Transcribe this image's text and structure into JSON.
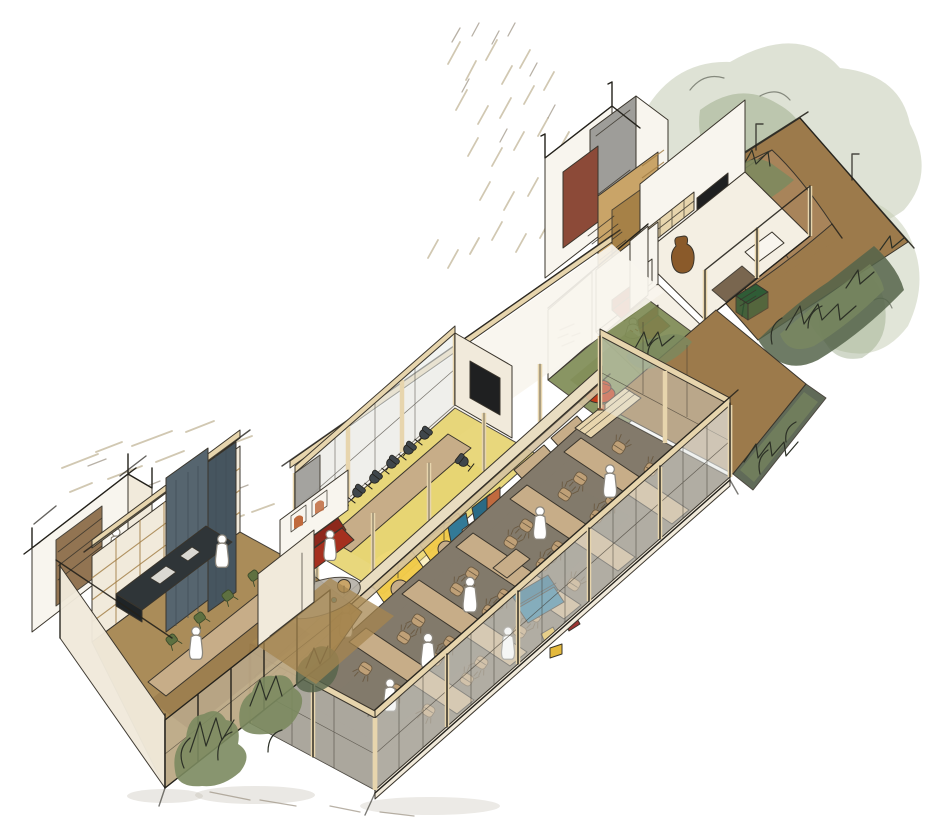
{
  "illustration": {
    "type": "axonometric-cutaway-sketch",
    "subject": "Hand-drawn watercolor axonometric cutaway of an office and hospitality interior with garden terrace",
    "rooms": [
      {
        "id": "garden-terrace",
        "label": "Garden terrace with canvas canopy and dense planting"
      },
      {
        "id": "utility-block",
        "label": "WC and utility block with gray and terracotta walls"
      },
      {
        "id": "media-lounge",
        "label": "Lounge with wall screen, shelving and vase"
      },
      {
        "id": "heart-nook",
        "label": "Seating nook with red armchairs and heart artwork"
      },
      {
        "id": "turf-patio",
        "label": "Indoor green turf patio with red pouf"
      },
      {
        "id": "focus-booths",
        "label": "Focus booths with yellow alcoves and blue bench seating"
      },
      {
        "id": "meeting-room",
        "label": "Glazed meeting room with long table and task chairs"
      },
      {
        "id": "dining-hall",
        "label": "Glazed dining hall with long communal tables"
      },
      {
        "id": "garden-path",
        "label": "Planted garden path along the facade"
      },
      {
        "id": "library-lounge",
        "label": "Lounge with shelf wall, slate curtain, dark stage table and red sofa"
      },
      {
        "id": "planter-facade",
        "label": "Glazed facade with planter boxes"
      }
    ],
    "furniture_counts": {
      "dining_tables": 5,
      "dining_chairs": 26,
      "meeting_chairs": 8,
      "sofas": 3,
      "armchairs": 2,
      "poufs": 1,
      "framed_artworks": 4
    }
  },
  "palette": {
    "paper": "#ffffff",
    "ink": "#3a352c",
    "ink_dark": "#23211b",
    "pencil": "#cfc5ae",
    "pencil_dark": "#9a9080",
    "wall_cream": "#f1eadb",
    "wall_white": "#f8f5ee",
    "wall_shade": "#e3dac6",
    "wall_gray": "#9e9d99",
    "terracotta": "#8c4a38",
    "wood_light": "#e7d5ad",
    "wood_tan": "#c9a468",
    "wood_dark": "#a07c42",
    "floor_ochre": "#a5854f",
    "floor_hall": "#837a6b",
    "floor_cream": "#f4efe3",
    "turf_green": "#7d8a53",
    "floor_yellow": "#e6d36e",
    "alcove_yellow": "#f2cb49",
    "table_beige": "#c7ad88",
    "counter_beige": "#e9ddc1",
    "counter_shade": "#d6c4a2",
    "chair_tan": "#bfa077",
    "chair_dark": "#3f464b",
    "chair_green": "#5e7040",
    "curtain_slate": "#56656f",
    "curtain_dark": "#46555f",
    "sofa_red": "#a5301f",
    "red_dark": "#8d281c",
    "pouf_red": "#c23b1a",
    "booth_blue": "#337a97",
    "blue_dark": "#2a6a85",
    "accent_yellow": "#e4b93c",
    "accent_darkred": "#9c3532",
    "canopy_tan": "#a8845a",
    "canopy_light": "#b79360",
    "garden_ground": "#9c7a4b",
    "plant_soft": "#c3cbb2",
    "plant_mid": "#9aa988",
    "plant_green": "#7b8a5f",
    "plant_dark": "#55644a",
    "plant_ink": "#2c3026",
    "hedge": "#4f5a47",
    "rug_gray": "#b5b0a7",
    "tv_dark": "#1f2021",
    "stage_dark": "#2f3538",
    "glass_tint": "#e9ece9",
    "person_outline": "#8b867c",
    "shadow": "#b9b2a6",
    "closet_brown": "#8a6a45",
    "mat_brown": "#6f5b43",
    "vase_brown": "#8a5a2a",
    "art_orange": "#c06a3e",
    "heart_pink": "#c97f73",
    "crate_green": "#2f5c36",
    "teal_small": "#2e7d92"
  }
}
